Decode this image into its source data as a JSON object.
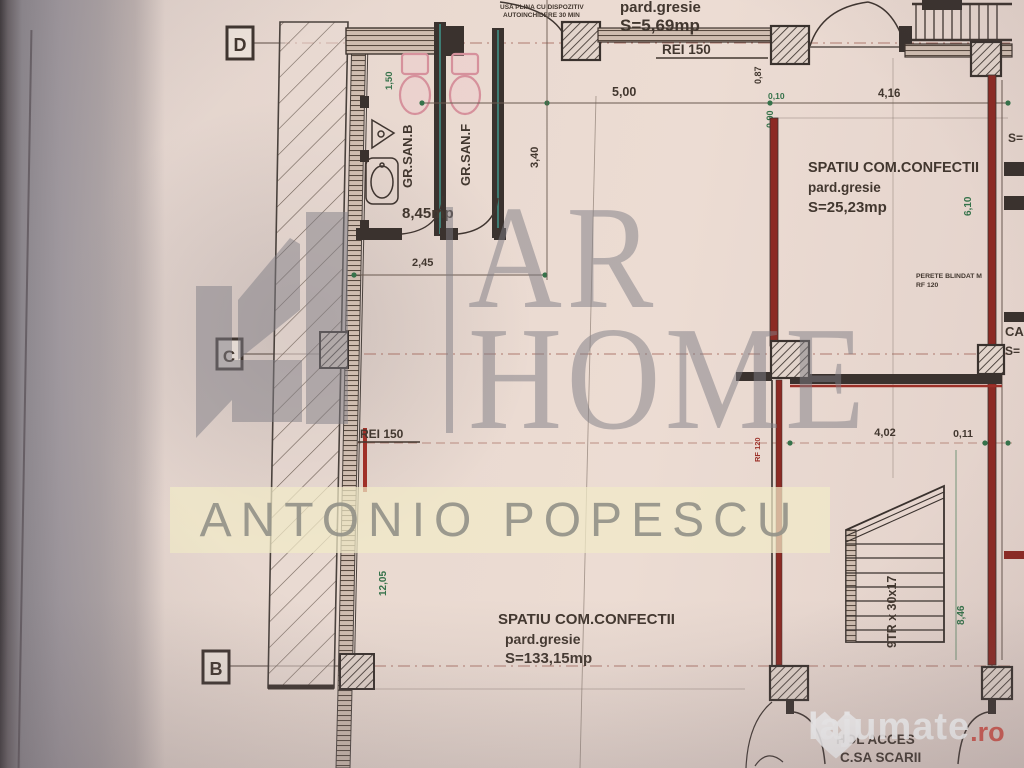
{
  "palette": {
    "paper": "#e9d9d0",
    "line": "#3f3530",
    "green": "#35724a",
    "red": "#9c3028",
    "pink": "#d6919c",
    "teal": "#3e7d74",
    "watermark_gray": "#7d7b83",
    "band_yellow": "#f1eac8"
  },
  "grid_markers": {
    "d": "D",
    "c": "C",
    "b": "B"
  },
  "rooms": {
    "vestibule": {
      "finish": "pard.gresie",
      "area": "S=5,69mp"
    },
    "san_b": "GR.SAN.B",
    "san_f": "GR.SAN.F",
    "san_area": "8,45mp",
    "confectii_small": {
      "name": "SPATIU COM.CONFECTII",
      "finish": "pard.gresie",
      "area": "S=25,23mp"
    },
    "confectii_large": {
      "name": "SPATIU COM.CONFECTII",
      "finish": "pard.gresie",
      "area": "S=133,15mp"
    },
    "hol_line1": "HOL ACCES",
    "hol_line2": "C.SA SCARII"
  },
  "annotations": {
    "rei150_top": "REI 150",
    "rei150_left": "REI 150",
    "door_note1": "USA PLINA CU DISPOZITIV",
    "door_note2": "AUTOINCHIDERE 30 MIN",
    "perete1": "PERETE BLINDAT M",
    "perete2": "RF 120",
    "rf120": "RF 120",
    "stair_note": "9TR x 30x17",
    "edge_s_top": "S=",
    "edge_ca": "CA",
    "edge_s_mid": "S="
  },
  "dimensions": {
    "w500": "5,00",
    "w416": "4,16",
    "h087": "0,87",
    "w010": "0,10",
    "h090": "0,90",
    "h150": "1,50",
    "h340": "3,40",
    "w245": "2,45",
    "h610": "6,10",
    "w402": "4,02",
    "w011": "0,11",
    "h846": "8,46",
    "h1205": "12,05"
  },
  "watermarks": {
    "brand_top": "AR",
    "brand_bottom": "HOME",
    "agent_name": "ANTONIO POPESCU",
    "site_name": "lajumate",
    "site_tld": ".ro"
  }
}
